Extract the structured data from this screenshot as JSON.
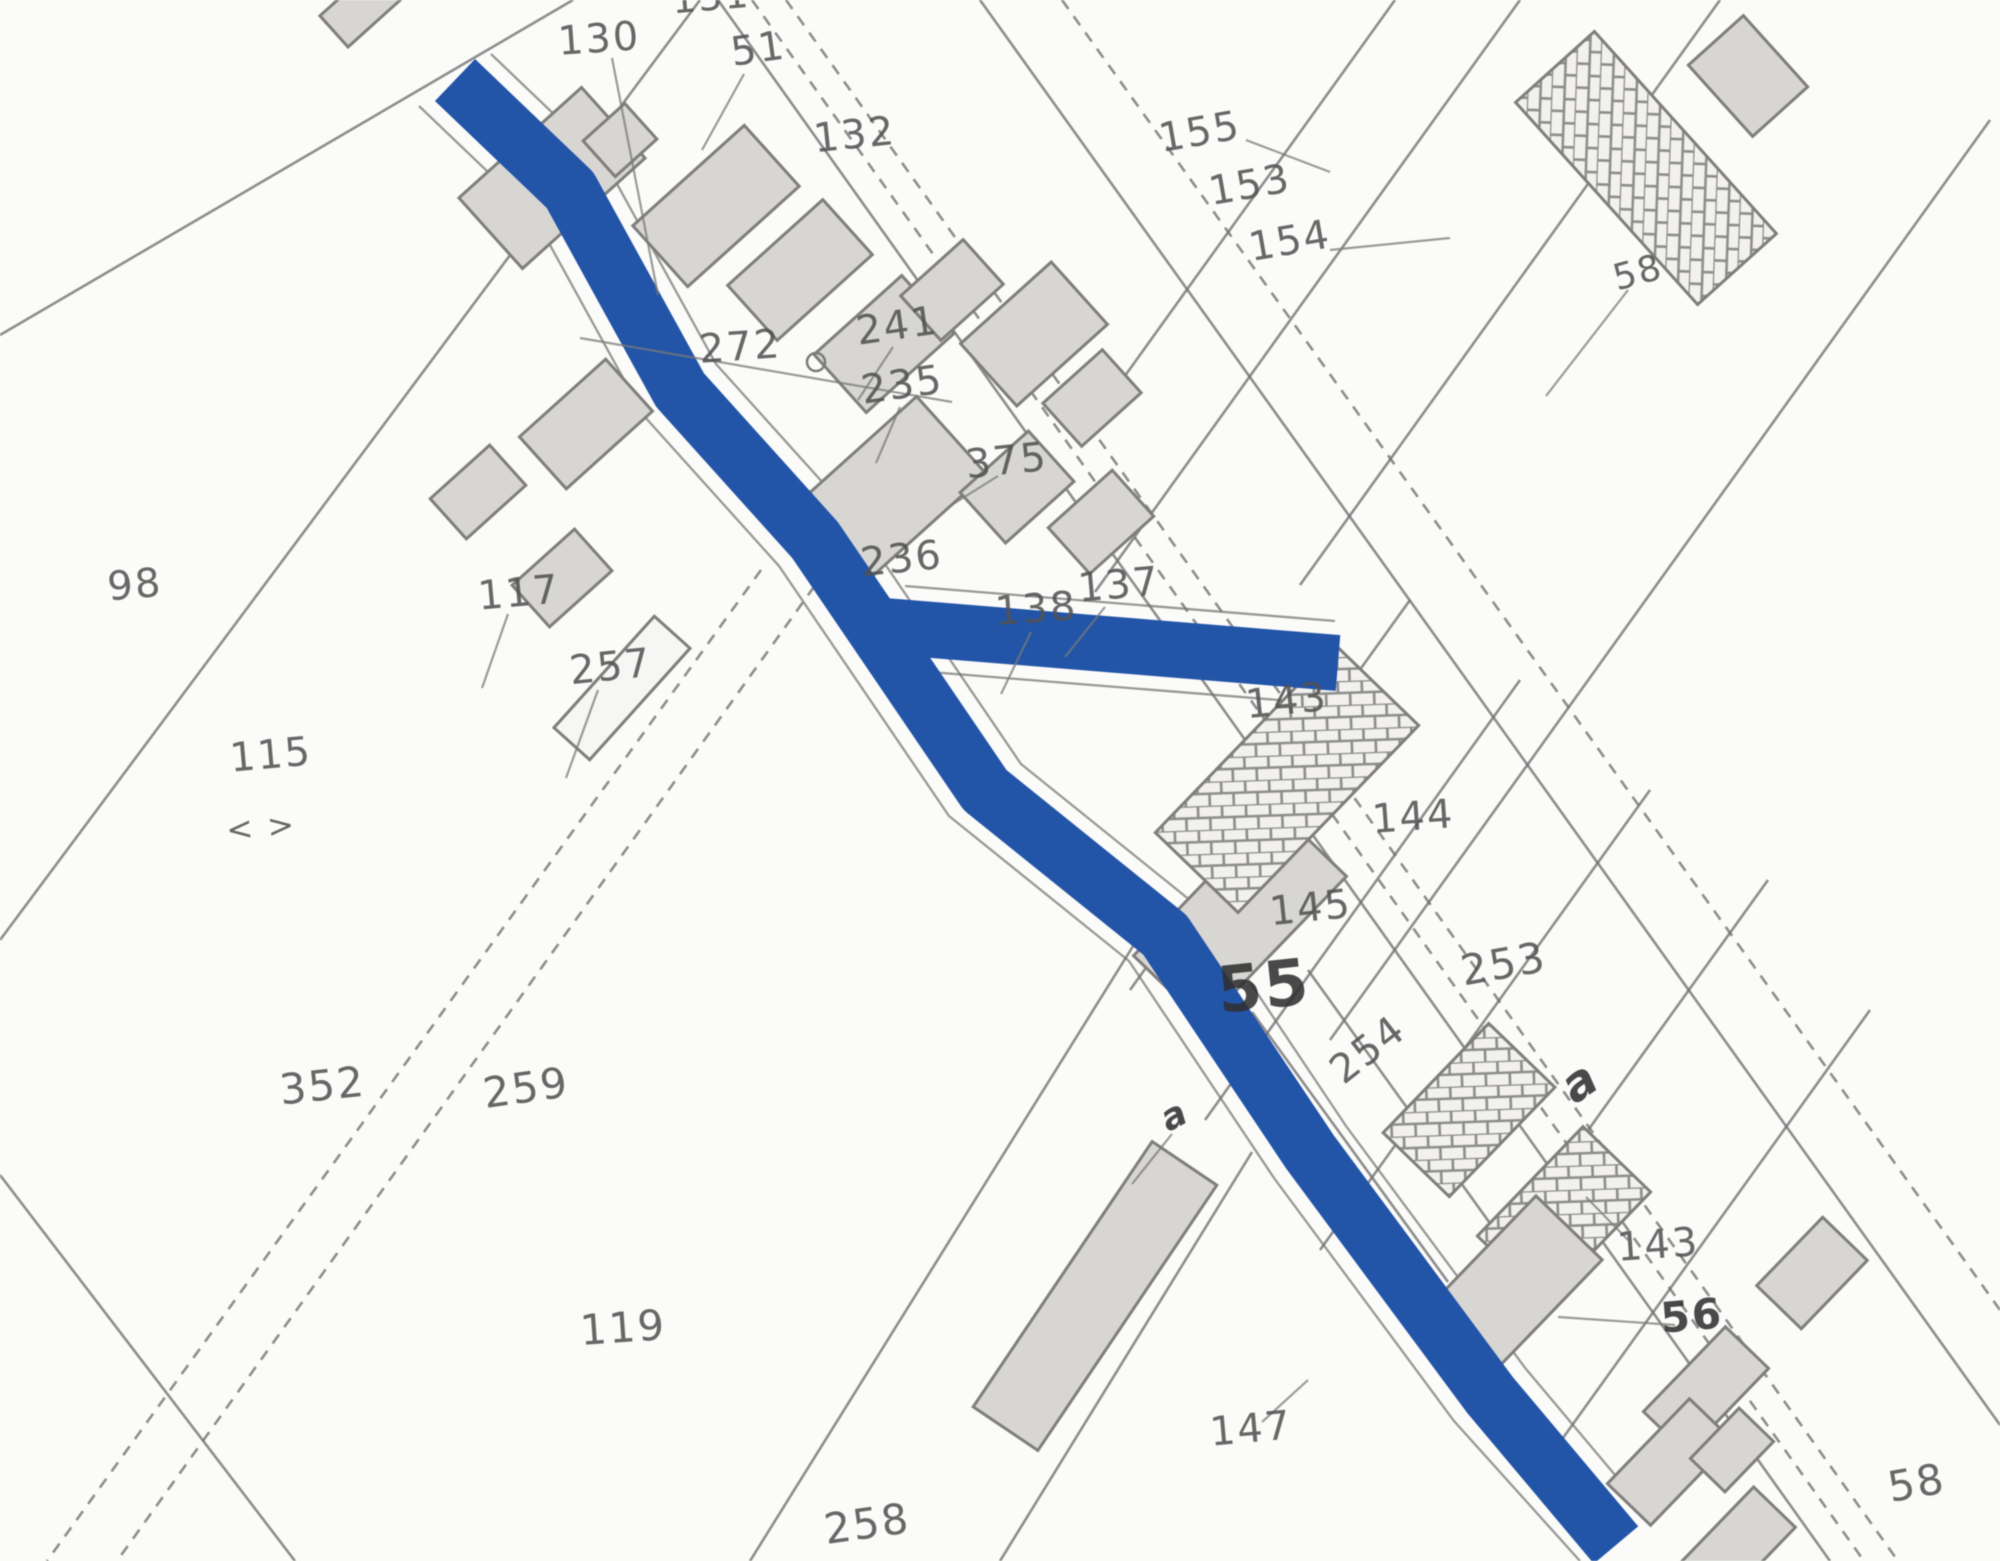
{
  "map": {
    "colors": {
      "paper": "#fbfbf9",
      "boundary": "#6e6e6e",
      "leader": "#7a7a7a",
      "building_fill": "#d7d6d3",
      "building_stroke": "#7f7e7c",
      "hatch_stroke": "#8b8b89",
      "open_fill": "#f6f6f4",
      "highlight": "#2254a8",
      "label": "#525252",
      "label_bold": "#303030"
    },
    "highlighted_routes": [
      {
        "name": "main-road",
        "width": 58,
        "points": [
          [
            455,
            80
          ],
          [
            570,
            190
          ],
          [
            680,
            390
          ],
          [
            815,
            540
          ],
          [
            985,
            790
          ],
          [
            1165,
            935
          ],
          [
            1310,
            1152
          ],
          [
            1490,
            1395
          ],
          [
            1616,
            1545
          ]
        ]
      },
      {
        "name": "side-arm",
        "width": 56,
        "points": [
          [
            872,
            625
          ],
          [
            1338,
            663
          ]
        ]
      }
    ],
    "casings": [
      {
        "points": [
          [
            491,
            54
          ],
          [
            606,
            164
          ],
          [
            716,
            364
          ],
          [
            851,
            514
          ],
          [
            1021,
            764
          ],
          [
            1201,
            909
          ],
          [
            1346,
            1126
          ],
          [
            1526,
            1369
          ],
          [
            1652,
            1519
          ]
        ]
      },
      {
        "points": [
          [
            419,
            106
          ],
          [
            534,
            216
          ],
          [
            644,
            416
          ],
          [
            779,
            566
          ],
          [
            949,
            816
          ],
          [
            1129,
            961
          ],
          [
            1274,
            1178
          ],
          [
            1454,
            1421
          ],
          [
            1580,
            1561
          ]
        ]
      },
      {
        "points": [
          [
            905,
            586
          ],
          [
            1335,
            621
          ]
        ]
      },
      {
        "points": [
          [
            905,
            670
          ],
          [
            1341,
            705
          ]
        ]
      }
    ],
    "boundary_lines": [
      {
        "x1": 718,
        "y1": 0,
        "x2": 1830,
        "y2": 1561,
        "dashed": false
      },
      {
        "x1": 752,
        "y1": 0,
        "x2": 1864,
        "y2": 1561,
        "dashed": true
      },
      {
        "x1": 786,
        "y1": 0,
        "x2": 1898,
        "y2": 1561,
        "dashed": true
      },
      {
        "x1": 980,
        "y1": 0,
        "x2": 2000,
        "y2": 1425,
        "dashed": false
      },
      {
        "x1": 1062,
        "y1": 0,
        "x2": 2000,
        "y2": 1310,
        "dashed": true
      },
      {
        "x1": 1395,
        "y1": 0,
        "x2": 1099,
        "y2": 412,
        "dashed": false
      },
      {
        "x1": 1520,
        "y1": 0,
        "x2": 1095,
        "y2": 592,
        "dashed": false
      },
      {
        "x1": 1720,
        "y1": 0,
        "x2": 1300,
        "y2": 585,
        "dashed": false
      },
      {
        "x1": 1990,
        "y1": 120,
        "x2": 1330,
        "y2": 1040,
        "dashed": false
      },
      {
        "x1": 1410,
        "y1": 600,
        "x2": 1130,
        "y2": 990,
        "dashed": false
      },
      {
        "x1": 1520,
        "y1": 680,
        "x2": 1205,
        "y2": 1120,
        "dashed": false
      },
      {
        "x1": 1650,
        "y1": 790,
        "x2": 1320,
        "y2": 1250,
        "dashed": false
      },
      {
        "x1": 1768,
        "y1": 880,
        "x2": 1430,
        "y2": 1350,
        "dashed": false
      },
      {
        "x1": 1870,
        "y1": 1010,
        "x2": 1540,
        "y2": 1470,
        "dashed": false
      },
      {
        "x1": 1252,
        "y1": 1012,
        "x2": 1448,
        "y2": 1282,
        "dashed": false
      },
      {
        "x1": 1308,
        "y1": 970,
        "x2": 1502,
        "y2": 1240,
        "dashed": false
      },
      {
        "x1": 573,
        "y1": 0,
        "x2": 0,
        "y2": 335,
        "dashed": false
      },
      {
        "x1": 700,
        "y1": 0,
        "x2": 0,
        "y2": 940,
        "dashed": false
      },
      {
        "x1": 0,
        "y1": 1175,
        "x2": 295,
        "y2": 1561,
        "dashed": false
      },
      {
        "x1": 761,
        "y1": 570,
        "x2": 47,
        "y2": 1561,
        "dashed": true
      },
      {
        "x1": 826,
        "y1": 570,
        "x2": 117,
        "y2": 1561,
        "dashed": true
      },
      {
        "x1": 1000,
        "y1": 1561,
        "x2": 1252,
        "y2": 1152,
        "dashed": false
      },
      {
        "x1": 750,
        "y1": 1561,
        "x2": 1135,
        "y2": 943,
        "dashed": false
      }
    ],
    "leader_lines": [
      {
        "x1": 612,
        "y1": 58,
        "x2": 658,
        "y2": 295
      },
      {
        "x1": 744,
        "y1": 74,
        "x2": 702,
        "y2": 150
      },
      {
        "x1": 580,
        "y1": 338,
        "x2": 952,
        "y2": 402
      },
      {
        "x1": 893,
        "y1": 347,
        "x2": 858,
        "y2": 400
      },
      {
        "x1": 900,
        "y1": 407,
        "x2": 876,
        "y2": 463
      },
      {
        "x1": 998,
        "y1": 476,
        "x2": 950,
        "y2": 506
      },
      {
        "x1": 1105,
        "y1": 607,
        "x2": 1065,
        "y2": 657
      },
      {
        "x1": 1031,
        "y1": 632,
        "x2": 1001,
        "y2": 694
      },
      {
        "x1": 1246,
        "y1": 140,
        "x2": 1330,
        "y2": 172
      },
      {
        "x1": 1330,
        "y1": 250,
        "x2": 1450,
        "y2": 238
      },
      {
        "x1": 1628,
        "y1": 290,
        "x2": 1546,
        "y2": 396
      },
      {
        "x1": 598,
        "y1": 690,
        "x2": 566,
        "y2": 778
      },
      {
        "x1": 508,
        "y1": 614,
        "x2": 482,
        "y2": 688
      },
      {
        "x1": 1172,
        "y1": 1134,
        "x2": 1132,
        "y2": 1184
      },
      {
        "x1": 1262,
        "y1": 1422,
        "x2": 1308,
        "y2": 1380
      },
      {
        "x1": 1628,
        "y1": 1240,
        "x2": 1586,
        "y2": 1197
      },
      {
        "x1": 1558,
        "y1": 1317,
        "x2": 1675,
        "y2": 1325
      }
    ],
    "symbols": [
      {
        "type": "ring",
        "x": 816,
        "y": 362,
        "r": 9
      }
    ],
    "buildings": [
      {
        "cx": 360,
        "cy": 8,
        "w": 70,
        "h": 42,
        "rot": -42,
        "style": "solid"
      },
      {
        "cx": 552,
        "cy": 178,
        "w": 165,
        "h": 95,
        "rot": -42,
        "style": "solid"
      },
      {
        "cx": 716,
        "cy": 206,
        "w": 150,
        "h": 82,
        "rot": -42,
        "style": "solid"
      },
      {
        "cx": 620,
        "cy": 140,
        "w": 56,
        "h": 48,
        "rot": -42,
        "style": "solid"
      },
      {
        "cx": 800,
        "cy": 270,
        "w": 128,
        "h": 74,
        "rot": -42,
        "style": "solid"
      },
      {
        "cx": 884,
        "cy": 344,
        "w": 118,
        "h": 78,
        "rot": -42,
        "style": "solid"
      },
      {
        "cx": 952,
        "cy": 290,
        "w": 84,
        "h": 60,
        "rot": -42,
        "style": "solid"
      },
      {
        "cx": 1034,
        "cy": 334,
        "w": 122,
        "h": 84,
        "rot": -42,
        "style": "solid"
      },
      {
        "cx": 1092,
        "cy": 398,
        "w": 80,
        "h": 58,
        "rot": -42,
        "style": "solid"
      },
      {
        "cx": 886,
        "cy": 494,
        "w": 176,
        "h": 104,
        "rot": -42,
        "style": "solid"
      },
      {
        "cx": 1017,
        "cy": 487,
        "w": 92,
        "h": 68,
        "rot": -42,
        "style": "solid"
      },
      {
        "cx": 1101,
        "cy": 522,
        "w": 86,
        "h": 62,
        "rot": -42,
        "style": "solid"
      },
      {
        "cx": 586,
        "cy": 424,
        "w": 116,
        "h": 70,
        "rot": -42,
        "style": "solid"
      },
      {
        "cx": 478,
        "cy": 492,
        "w": 80,
        "h": 54,
        "rot": -42,
        "style": "solid"
      },
      {
        "cx": 562,
        "cy": 578,
        "w": 84,
        "h": 56,
        "rot": -42,
        "style": "solid"
      },
      {
        "cx": 622,
        "cy": 688,
        "w": 150,
        "h": 48,
        "rot": -48,
        "style": "open"
      },
      {
        "cx": 1240,
        "cy": 916,
        "w": 205,
        "h": 98,
        "rot": -46,
        "style": "solid"
      },
      {
        "cx": 1287,
        "cy": 779,
        "w": 260,
        "h": 115,
        "rot": -46,
        "style": "hatched"
      },
      {
        "cx": 1469,
        "cy": 1110,
        "w": 152,
        "h": 92,
        "rot": -46,
        "style": "hatched"
      },
      {
        "cx": 1564,
        "cy": 1214,
        "w": 152,
        "h": 94,
        "rot": -46,
        "style": "hatched"
      },
      {
        "cx": 1510,
        "cy": 1289,
        "w": 170,
        "h": 92,
        "rot": -46,
        "style": "solid"
      },
      {
        "cx": 1646,
        "cy": 168,
        "w": 272,
        "h": 106,
        "rot": 48,
        "style": "hatched"
      },
      {
        "cx": 1748,
        "cy": 76,
        "w": 96,
        "h": 74,
        "rot": 48,
        "style": "solid"
      },
      {
        "cx": 1812,
        "cy": 1273,
        "w": 95,
        "h": 62,
        "rot": -46,
        "style": "solid"
      },
      {
        "cx": 1706,
        "cy": 1390,
        "w": 118,
        "h": 60,
        "rot": -46,
        "style": "solid"
      },
      {
        "cx": 1670,
        "cy": 1462,
        "w": 118,
        "h": 60,
        "rot": -46,
        "style": "solid"
      },
      {
        "cx": 1732,
        "cy": 1450,
        "w": 70,
        "h": 48,
        "rot": -46,
        "style": "solid"
      },
      {
        "cx": 1737,
        "cy": 1546,
        "w": 108,
        "h": 58,
        "rot": -46,
        "style": "solid"
      },
      {
        "cx": 1095,
        "cy": 1296,
        "w": 320,
        "h": 78,
        "rot": -56,
        "style": "solid"
      }
    ],
    "parcel_labels": [
      {
        "text": "131",
        "x": 712,
        "y": 10,
        "size": 38,
        "rot": -5
      },
      {
        "text": "130",
        "x": 600,
        "y": 52,
        "size": 40,
        "rot": -4
      },
      {
        "text": "51",
        "x": 760,
        "y": 62,
        "size": 40,
        "rot": -8
      },
      {
        "text": "132",
        "x": 856,
        "y": 148,
        "size": 40,
        "rot": -6
      },
      {
        "text": "155",
        "x": 1202,
        "y": 145,
        "size": 40,
        "rot": -10
      },
      {
        "text": "153",
        "x": 1252,
        "y": 198,
        "size": 40,
        "rot": -10
      },
      {
        "text": "154",
        "x": 1292,
        "y": 254,
        "size": 40,
        "rot": -10
      },
      {
        "text": "58",
        "x": 1641,
        "y": 284,
        "size": 36,
        "rot": -15
      },
      {
        "text": "272",
        "x": 741,
        "y": 360,
        "size": 40,
        "rot": -4
      },
      {
        "text": "241",
        "x": 899,
        "y": 339,
        "size": 40,
        "rot": -8
      },
      {
        "text": "235",
        "x": 904,
        "y": 398,
        "size": 40,
        "rot": -8
      },
      {
        "text": "375",
        "x": 1008,
        "y": 474,
        "size": 40,
        "rot": -6
      },
      {
        "text": "236",
        "x": 903,
        "y": 572,
        "size": 40,
        "rot": -6
      },
      {
        "text": "137",
        "x": 1120,
        "y": 598,
        "size": 40,
        "rot": -5
      },
      {
        "text": "138",
        "x": 1037,
        "y": 622,
        "size": 40,
        "rot": -4
      },
      {
        "text": "143",
        "x": 1288,
        "y": 714,
        "size": 40,
        "rot": -6
      },
      {
        "text": "144",
        "x": 1414,
        "y": 830,
        "size": 40,
        "rot": -4
      },
      {
        "text": "145",
        "x": 1312,
        "y": 921,
        "size": 40,
        "rot": -6
      },
      {
        "text": "55",
        "x": 1266,
        "y": 1008,
        "size": 64,
        "rot": -6,
        "weight": "bold"
      },
      {
        "text": "253",
        "x": 1506,
        "y": 978,
        "size": 42,
        "rot": -10
      },
      {
        "text": "254",
        "x": 1376,
        "y": 1060,
        "size": 40,
        "rot": -38
      },
      {
        "text": "a",
        "x": 1589,
        "y": 1095,
        "size": 48,
        "rot": -35,
        "weight": "bold",
        "style": "italic"
      },
      {
        "text": "a",
        "x": 1180,
        "y": 1126,
        "size": 36,
        "rot": -28,
        "weight": "bold",
        "style": "italic"
      },
      {
        "text": "98",
        "x": 136,
        "y": 598,
        "size": 40,
        "rot": -5
      },
      {
        "text": "115",
        "x": 272,
        "y": 768,
        "size": 40,
        "rot": -5
      },
      {
        "text": "< >",
        "x": 262,
        "y": 838,
        "size": 32,
        "rot": -5
      },
      {
        "text": "117",
        "x": 520,
        "y": 606,
        "size": 40,
        "rot": -5
      },
      {
        "text": "257",
        "x": 612,
        "y": 680,
        "size": 40,
        "rot": -6
      },
      {
        "text": "352",
        "x": 324,
        "y": 1100,
        "size": 42,
        "rot": -6
      },
      {
        "text": "259",
        "x": 528,
        "y": 1102,
        "size": 42,
        "rot": -8
      },
      {
        "text": "119",
        "x": 624,
        "y": 1342,
        "size": 42,
        "rot": -4
      },
      {
        "text": "258",
        "x": 869,
        "y": 1538,
        "size": 42,
        "rot": -8
      },
      {
        "text": "147",
        "x": 1252,
        "y": 1442,
        "size": 40,
        "rot": -5
      },
      {
        "text": "143",
        "x": 1659,
        "y": 1258,
        "size": 40,
        "rot": -4
      },
      {
        "text": "56",
        "x": 1693,
        "y": 1330,
        "size": 42,
        "rot": -5,
        "weight": "bold"
      },
      {
        "text": "58",
        "x": 1919,
        "y": 1497,
        "size": 42,
        "rot": -10
      }
    ]
  }
}
